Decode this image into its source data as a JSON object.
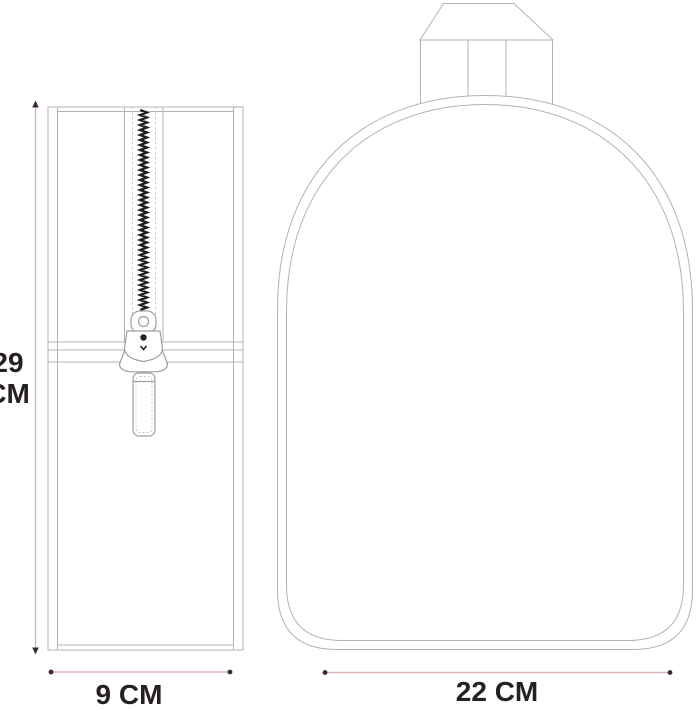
{
  "diagram": {
    "height_label": {
      "line1": "29",
      "line2": "CM"
    },
    "side_width_label": "9 CM",
    "front_width_label": "22 CM",
    "colors": {
      "background": "#ffffff",
      "outline_gray": "#b1b4b6",
      "outline_gray_light": "#c6c9cb",
      "zipper_teeth_black": "#1f1f1f",
      "dimension_line_pink": "#ddb3b3",
      "dimension_marker_dark": "#3a2d2d",
      "label_text": "#262022"
    }
  }
}
